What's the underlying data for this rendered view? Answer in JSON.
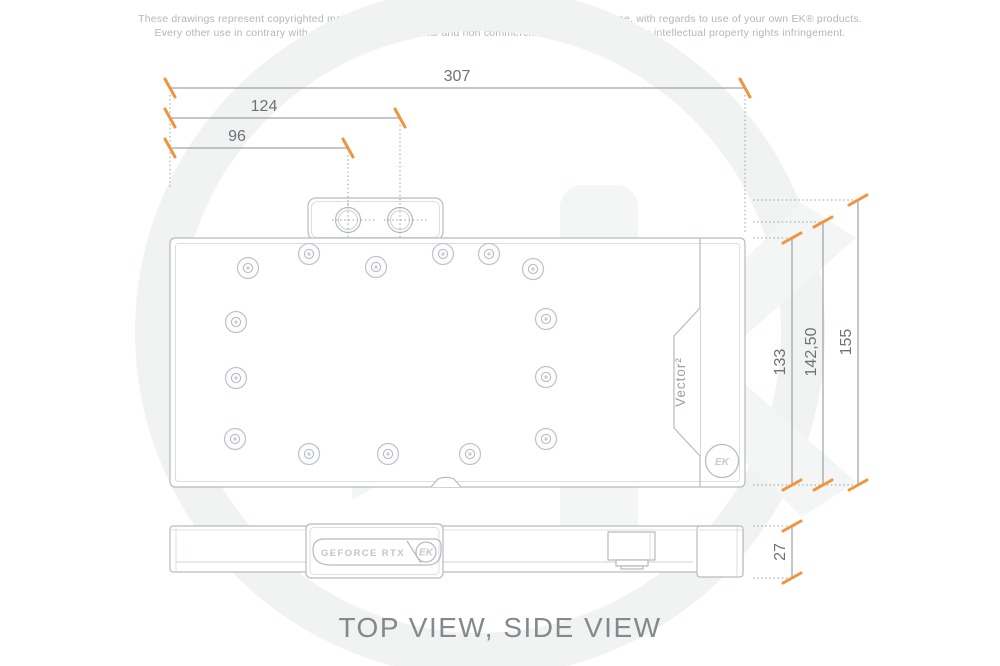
{
  "page": {
    "disclaimer_line1": "These drawings represent copyrighted material of EK® and they are meant only for your personal use, with regards to use of your own EK® products.",
    "disclaimer_line2": "Every other use in contrary with previously stated personal and non commercial use will be deemed as intellectual property rights infringement.",
    "title": "TOP VIEW, SIDE VIEW"
  },
  "colors": {
    "accent_tick": "#F0953F",
    "drawing_line": "#b6bac0",
    "dimension_line": "#8a8f93",
    "dimension_text": "#6e7276",
    "watermark": "#f3f4f4"
  },
  "dimensions": {
    "total_length": "307",
    "port2_offset": "124",
    "port1_offset": "96",
    "total_height": "155",
    "port_axis_height": "142,50",
    "block_height": "133",
    "thickness": "27"
  },
  "top_view": {
    "product_label": "Vector²",
    "ek_badge_monogram": "EK",
    "port_count": 2,
    "holes": [
      [
        248,
        268
      ],
      [
        309,
        254
      ],
      [
        376,
        267
      ],
      [
        443,
        254
      ],
      [
        489,
        254
      ],
      [
        533,
        269
      ],
      [
        236,
        322
      ],
      [
        236,
        378
      ],
      [
        235,
        439
      ],
      [
        546,
        319
      ],
      [
        546,
        377
      ],
      [
        546,
        439
      ],
      [
        309,
        454
      ],
      [
        388,
        454
      ],
      [
        470,
        454
      ]
    ]
  },
  "side_view": {
    "badge_text": "GEFORCE RTX",
    "ek_badge_monogram": "EK"
  }
}
